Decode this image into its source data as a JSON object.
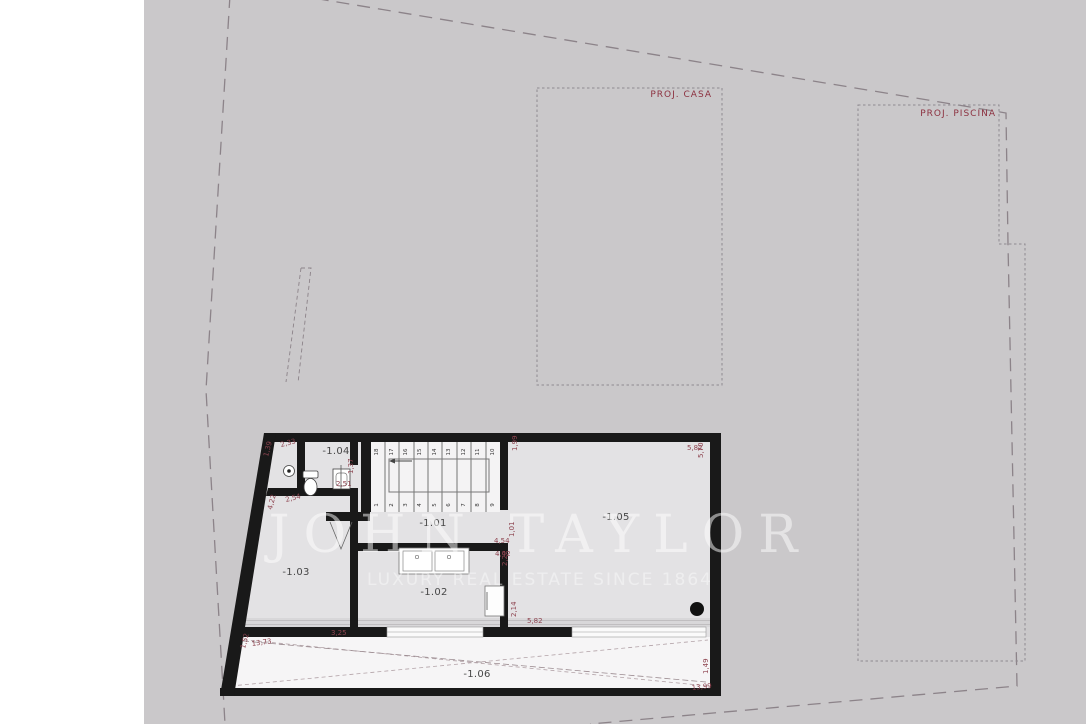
{
  "colors": {
    "site_background": "#cac8ca",
    "room_floor": "#e3e2e4",
    "terrace_floor": "#f6f5f6",
    "wall": "#191919",
    "dimension_text": "#8e4450",
    "project_label_text": "#8c3140",
    "boundary_line": "#8c8389",
    "watermark": "#ffffff"
  },
  "watermark": {
    "brand": "JOHN TAYLOR",
    "tagline": "LUXURY REAL ESTATE SINCE 1864"
  },
  "site": {
    "project_house_label": "PROJ. CASA",
    "project_pool_label": "PROJ. PISCINA"
  },
  "plan": {
    "rooms": [
      {
        "id": "-1.01"
      },
      {
        "id": "-1.02"
      },
      {
        "id": "-1.03"
      },
      {
        "id": "-1.04"
      },
      {
        "id": "-1.05"
      },
      {
        "id": "-1.06"
      }
    ],
    "stairs": {
      "top_row": [
        "18",
        "17",
        "16",
        "15",
        "14",
        "13",
        "12",
        "11",
        "10"
      ],
      "bottom_row": [
        "1",
        "2",
        "3",
        "4",
        "5",
        "6",
        "7",
        "8",
        "9"
      ]
    },
    "dimensions": [
      {
        "value": "2,33"
      },
      {
        "value": "1,39"
      },
      {
        "value": "2,54"
      },
      {
        "value": "4,22"
      },
      {
        "value": "1,37"
      },
      {
        "value": "2,51"
      },
      {
        "value": "1,99"
      },
      {
        "value": "5,82"
      },
      {
        "value": "5,70"
      },
      {
        "value": "4,54"
      },
      {
        "value": "1,01"
      },
      {
        "value": "4,42"
      },
      {
        "value": "2,22"
      },
      {
        "value": "2,14"
      },
      {
        "value": "5,82"
      },
      {
        "value": "3,25"
      },
      {
        "value": "13,73"
      },
      {
        "value": "1,52"
      },
      {
        "value": "13,99"
      },
      {
        "value": "1,49"
      }
    ]
  }
}
